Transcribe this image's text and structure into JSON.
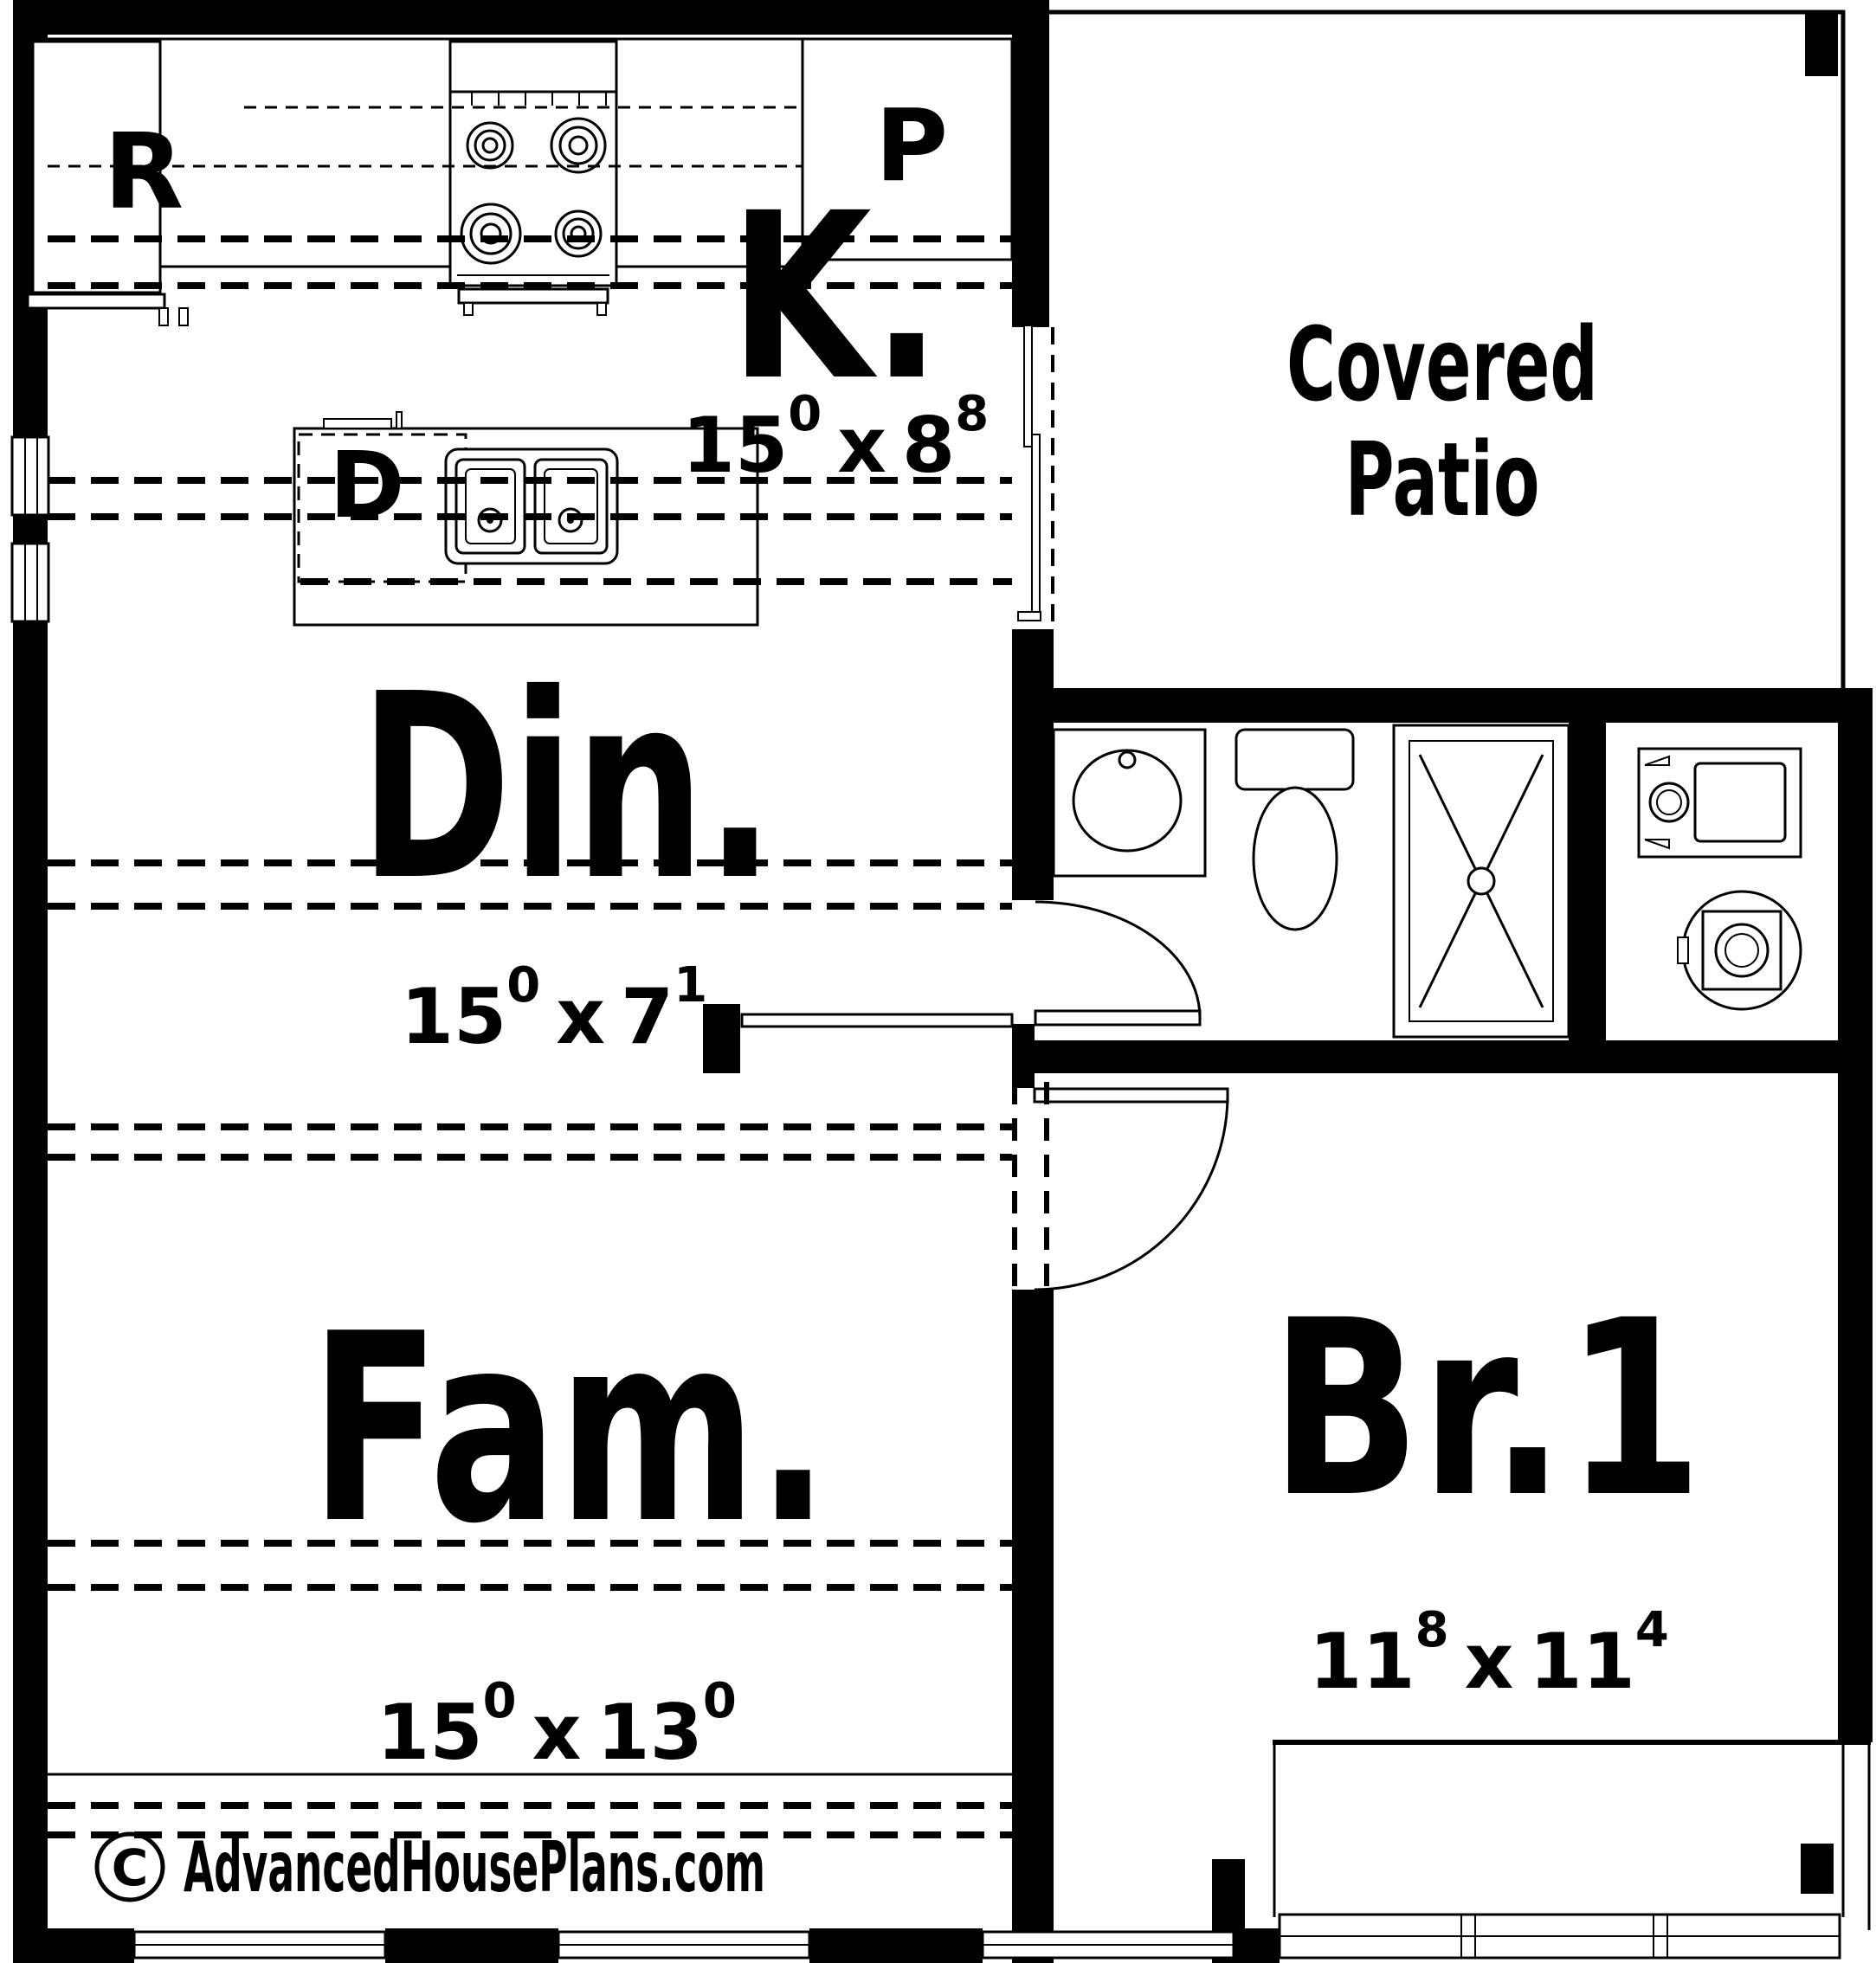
{
  "plan": {
    "title_hint": "single-level house floor plan",
    "colors": {
      "wall": "#000000",
      "background": "#ffffff",
      "linework": "#000000"
    },
    "rooms": {
      "kitchen": {
        "label": "K.",
        "dim": {
          "w": "15",
          "w_sup": "0",
          "sep": "x",
          "h": "8",
          "h_sup": "8"
        }
      },
      "dining": {
        "label": "Din.",
        "dim": {
          "w": "15",
          "w_sup": "0",
          "sep": "x",
          "h": "7",
          "h_sup": "1"
        }
      },
      "family": {
        "label": "Fam.",
        "dim": {
          "w": "15",
          "w_sup": "0",
          "sep": "x",
          "h": "13",
          "h_sup": "0"
        }
      },
      "bedroom1": {
        "label": "Br.1",
        "dim": {
          "w": "11",
          "w_sup": "8",
          "sep": "x",
          "h": "11",
          "h_sup": "4"
        }
      },
      "patio": {
        "label_line1": "Covered",
        "label_line2": "Patio"
      }
    },
    "appliances": {
      "refrigerator": "R",
      "pantry": "P",
      "dishwasher": "D"
    },
    "fixtures": [
      "range-stove",
      "kitchen-island-double-sink",
      "sliding-patio-door",
      "bath-vanity-sink",
      "toilet",
      "shower",
      "washer",
      "dryer",
      "windows",
      "hinged-doors",
      "bay-window"
    ],
    "watermark": {
      "symbol": "C",
      "text": "AdvancedHousePlans.com"
    }
  }
}
